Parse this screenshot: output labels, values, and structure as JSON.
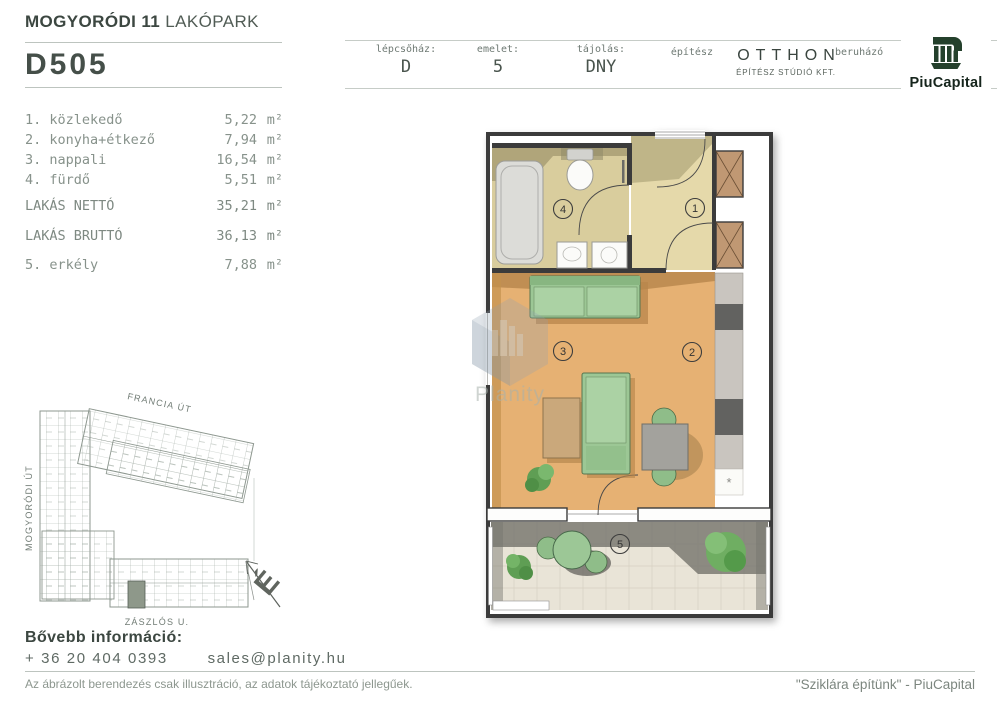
{
  "page": {
    "title_bold": "MOGYORÓDI 11",
    "title_light": "LAKÓPARK",
    "unit_id": "D505"
  },
  "info_bar": {
    "staircase_label": "lépcsőház:",
    "staircase_value": "D",
    "floor_label": "emelet:",
    "floor_value": "5",
    "orientation_label": "tájolás:",
    "orientation_value": "DNY",
    "architect_label": "építész",
    "architect_name": "OTTHON",
    "architect_subtitle": "ÉPÍTÉSZ STÚDIÓ KFT.",
    "developer_label": "beruházó",
    "developer_name": "PiuCapital"
  },
  "room_list": {
    "rooms": [
      {
        "label": "1. közlekedő",
        "area": "5,22",
        "unit": "m²"
      },
      {
        "label": "2. konyha+étkező",
        "area": "7,94",
        "unit": "m²"
      },
      {
        "label": "3. nappali",
        "area": "16,54",
        "unit": "m²"
      },
      {
        "label": "4. fürdő",
        "area": "5,51",
        "unit": "m²"
      }
    ],
    "net": {
      "label": "LAKÁS NETTÓ",
      "area": "35,21",
      "unit": "m²"
    },
    "gross": {
      "label": "LAKÁS BRUTTÓ",
      "area": "36,13",
      "unit": "m²"
    },
    "balcony": {
      "label": "5. erkély",
      "area": "7,88",
      "unit": "m²"
    }
  },
  "floor_plan": {
    "room_numbers": [
      "1",
      "2",
      "3",
      "4",
      "5"
    ],
    "star_symbol": "*",
    "colors": {
      "wood_floor": "#e6b173",
      "bath_floor": "#d9cd9d",
      "hall_floor": "#e5d9aa",
      "balcony_floor": "#e9e4d7",
      "wall": "#3b3b3b",
      "furniture_green": "#9cc795",
      "shadow_olive": "#aba177",
      "counter_light": "#c9c5bf",
      "counter_dark": "#626260",
      "shaft_tan": "#c09873"
    }
  },
  "site_plan": {
    "street_top": "FRANCIA ÚT",
    "street_left": "MOGYORÓDI ÚT",
    "street_bottom": "ZÁSZLÓS U.",
    "compass_letter": "É"
  },
  "watermark": {
    "brand": "Planity"
  },
  "footer": {
    "more_info_label": "Bővebb információ:",
    "phone": "+ 36 20 404 0393",
    "email": "sales@planity.hu",
    "disclaimer": "Az ábrázolt berendezés csak illusztráció, az adatok tájékoztató jellegűek.",
    "slogan": "\"Sziklára építünk\" - PiuCapital"
  }
}
